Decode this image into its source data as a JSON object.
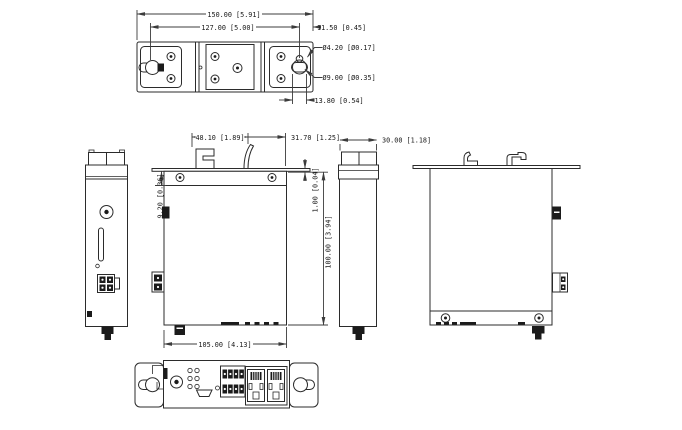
{
  "colors": {
    "line": "#2b2b2b",
    "dimension": "#3c3c3c",
    "background": "#ffffff"
  },
  "views": {
    "top": {
      "dims": {
        "overall_width": "150.00 [5.91]",
        "mount_hole_spacing": "127.00 [5.00]",
        "hole_edge_offset": "11.50 [0.45]",
        "small_hole_diameter": "Ø4.20 [Ø0.17]",
        "large_hole_diameter": "Ø9.00 [Ø0.35]",
        "keyhole_slot_length": "13.80 [0.54]"
      }
    },
    "front": {
      "dims": {
        "din_clip_width": "48.10 [1.89]",
        "din_clip_side_offset": "31.70 [1.25]",
        "top_recess": "9.20 [0.36]",
        "flange_thickness": "1.00 [0.04]",
        "body_height": "100.00 [3.94]",
        "body_width": "105.00 [4.13]"
      }
    },
    "right_side": {
      "dims": {
        "body_depth": "30.00 [1.18]"
      }
    }
  }
}
